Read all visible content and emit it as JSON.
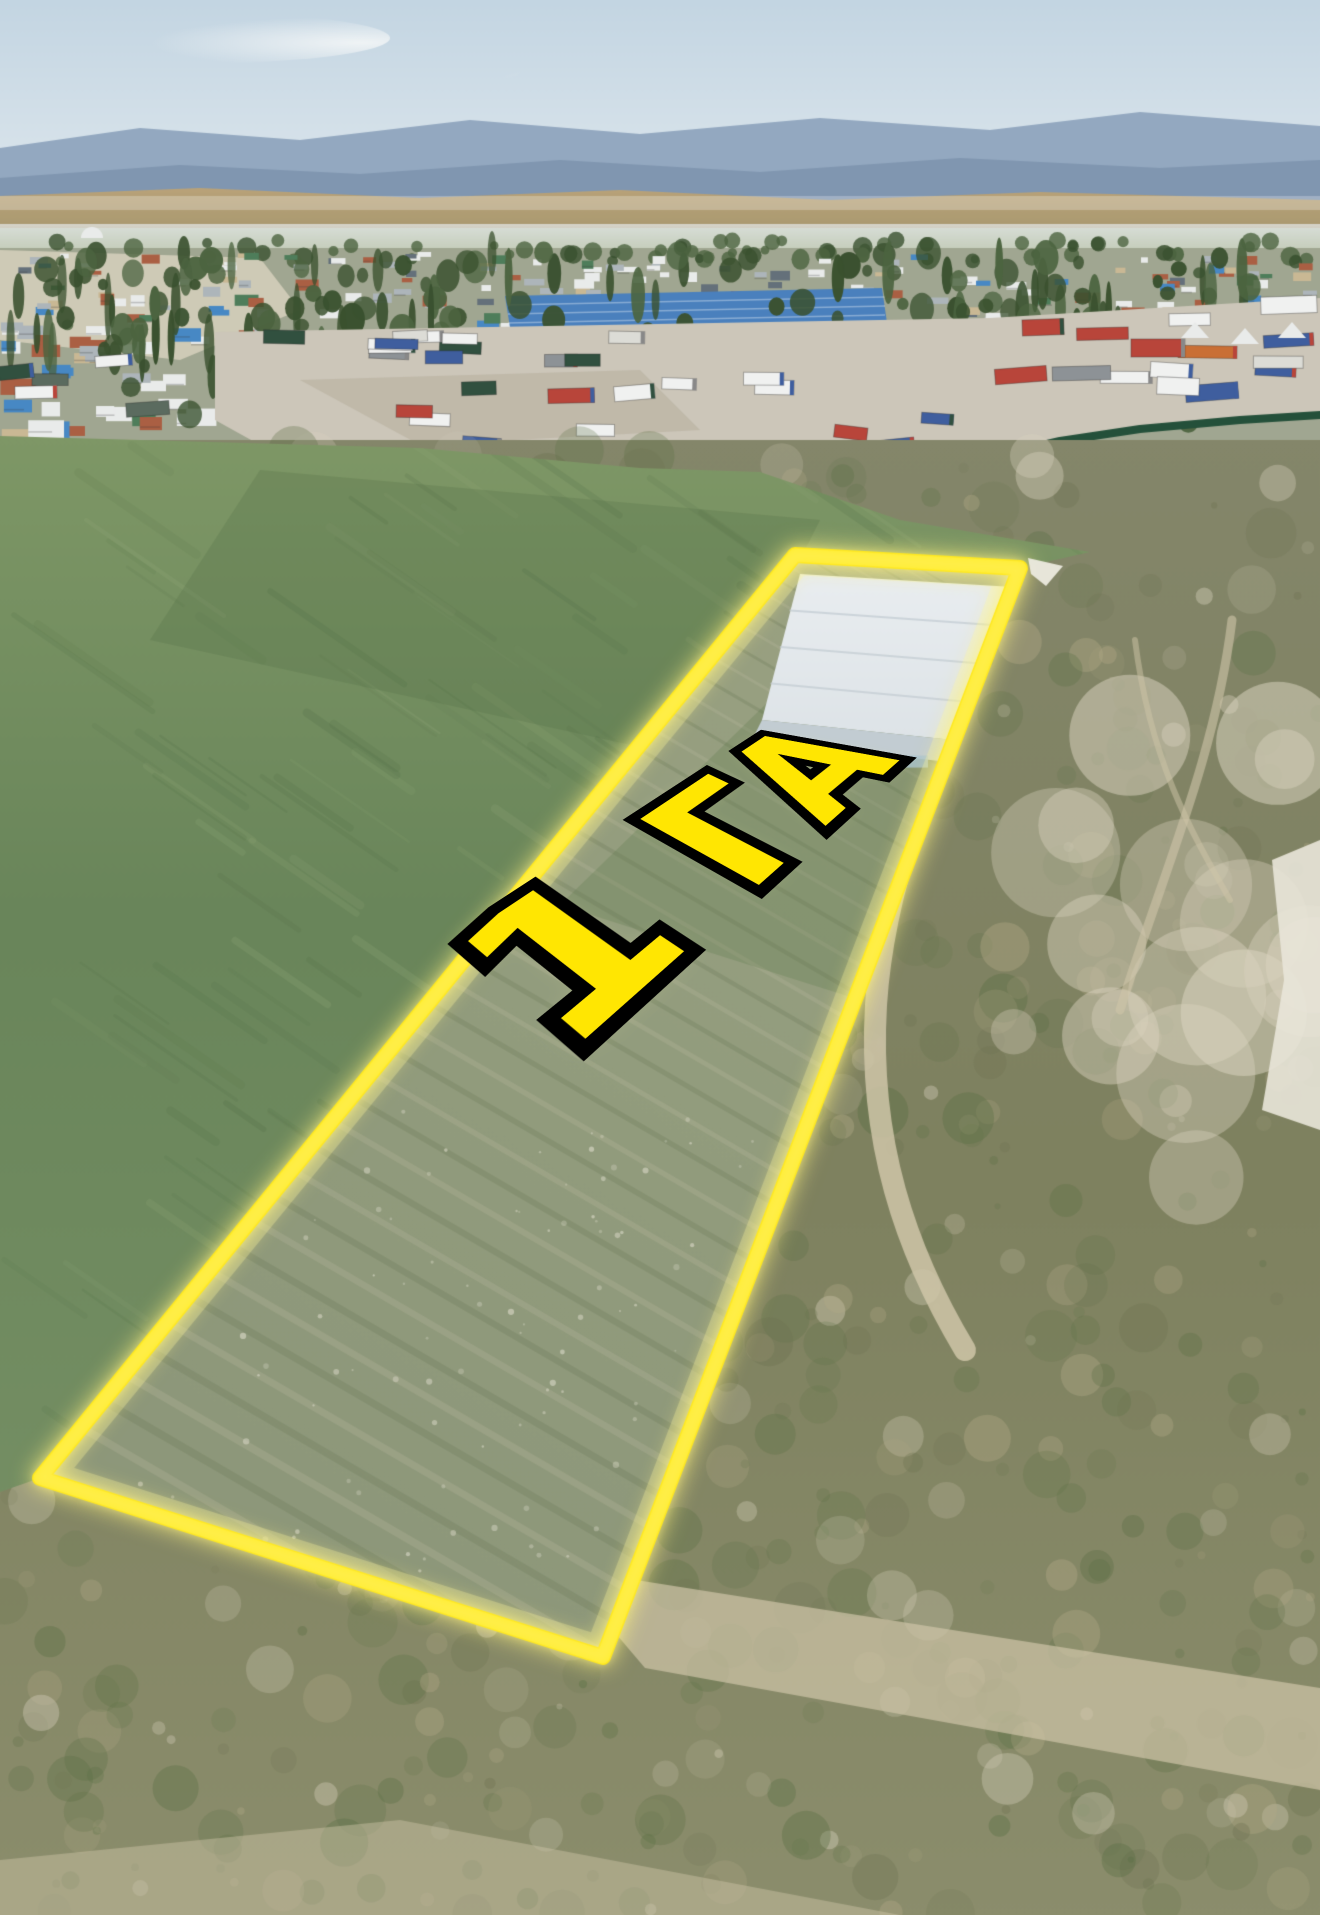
{
  "annotation": {
    "area_label": "1 ГА",
    "outline_color": "#ffe602",
    "outline_glow": "rgba(255,243,130,0.95)",
    "label_fill_color": "#ffe602",
    "label_stroke_color": "#000000"
  },
  "palette": {
    "sky_top": "#c3d5e2",
    "sky_bottom": "#e2eaef",
    "cloud": "#f1f4f5",
    "mountain_far": "#93a8c0",
    "mountain_near": "#7d93ad",
    "foothill": "#c2a77d",
    "foothill_shade": "#a5976e",
    "plain": "#b7c0a5",
    "haze": "#e8edf0",
    "village_ground": "#a0a691",
    "tree_dark": "#3a512f",
    "tree_mid": "#4c6440",
    "roof_white": "#e9ebea",
    "roof_gray": "#adb5ba",
    "roof_blue": "#4788c4",
    "roof_red": "#aa5f43",
    "roof_dark": "#64707a",
    "roof_green": "#4e7d5a",
    "roof_tan": "#c9b894",
    "warehouse_blue": "#4a80bd",
    "lot_ground": "#ccc6b9",
    "truck_white": "#f0f1f0",
    "truck_red": "#b8453a",
    "truck_blue": "#3f5e9e",
    "truck_dark": "#31503f",
    "truck_orange": "#c96f35",
    "fence_green": "#24503a",
    "shed_gray": "#c3cbd1",
    "grass_top": "#7e9766",
    "grass_mid": "#69855a",
    "grass_light": "#95ab7c",
    "grass_dark": "#4f6c44",
    "scrub_base": "#7e815f",
    "scrub_green": "#5a6f44",
    "scrub_tan": "#b2a987",
    "dirt_path": "#cfc5a8",
    "dirt_light": "#dad3bf",
    "rubble_white": "#e9e6d9",
    "plot_soil": "#929c7d",
    "plot_row_light": "#b5b79d",
    "plot_row_dark": "#6c7c5a",
    "plot_glow": "rgba(255,247,160,0.30)",
    "greenhouse_roof": "#e9edf0",
    "greenhouse_side": "#c2ccd2",
    "greenhouse_glint": "#a9c3d2"
  }
}
